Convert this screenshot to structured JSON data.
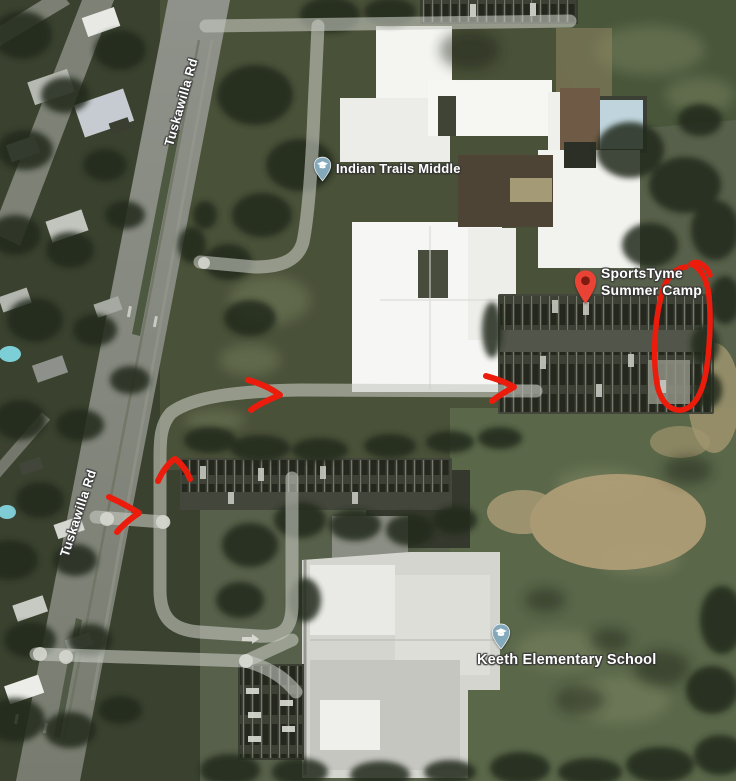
{
  "map": {
    "type": "satellite",
    "road_label": "Tuskawilla Rd",
    "pois": {
      "indian_trails": {
        "label": "Indian Trails Middle",
        "icon": "graduation-cap"
      },
      "sportstyme": {
        "line1": "SportsTyme",
        "line2": "Summer Camp",
        "icon": "red-map-pin"
      },
      "keeth": {
        "label": "Keeth Elementary School",
        "icon": "graduation-cap"
      }
    },
    "annotations": {
      "arrow_count": 4,
      "oval_count": 1,
      "description": "hand-drawn red route arrows leading to circled parking area"
    }
  },
  "colors": {
    "annotation": "#ec1c0d",
    "marker_red": "#ea4335",
    "marker_red_dot": "#7e1a10",
    "school_pin": "#84a9bb",
    "school_pin_glyph": "#ffffff"
  }
}
